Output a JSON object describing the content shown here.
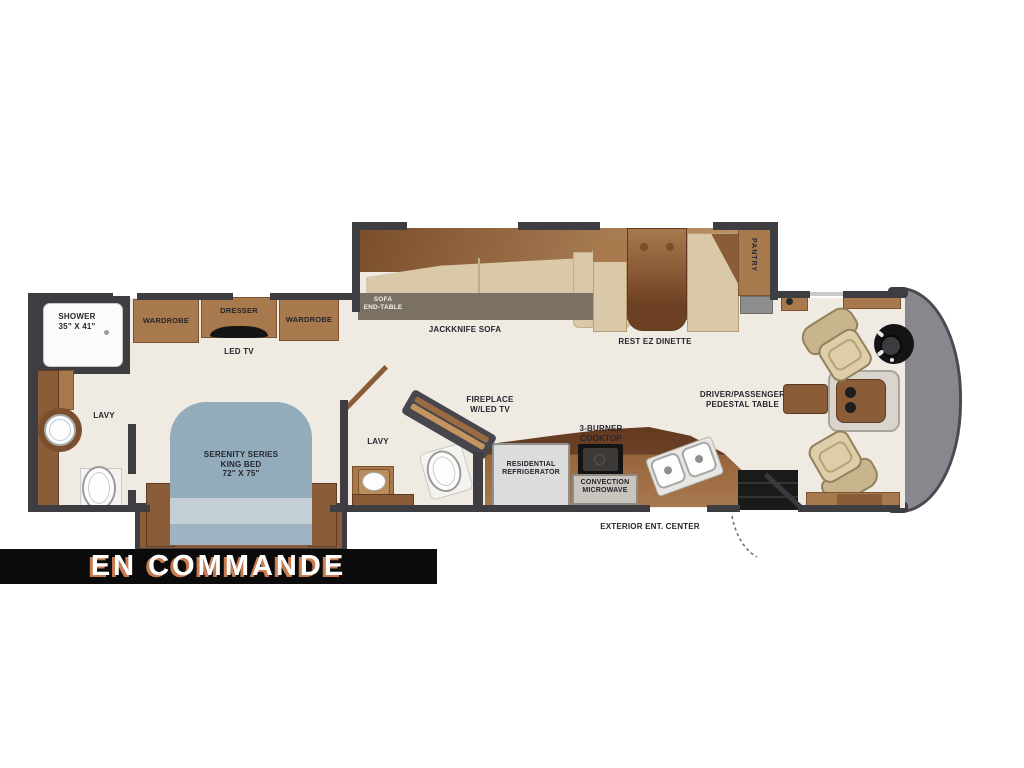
{
  "banner": {
    "text": "EN COMMANDE",
    "bg_color": "#0b0b0b",
    "text_color": "#ffffff",
    "shadow_color": "#c97b50"
  },
  "labels": {
    "shower_1": "SHOWER",
    "shower_2": "35\" X 41\"",
    "wardrobe_left": "WARDROBE",
    "dresser": "DRESSER",
    "wardrobe_right": "WARDROBE",
    "led_tv": "LED TV",
    "lavy_rear": "LAVY",
    "bed_1": "SERENITY SERIES",
    "bed_2": "KING BED",
    "bed_3": "72\" X 75\"",
    "lavy_mid": "LAVY",
    "sofa_end_1": "SOFA",
    "sofa_end_2": "END-TABLE",
    "jackknife_sofa": "JACKKNIFE SOFA",
    "dinette": "REST EZ DINETTE",
    "pantry": "PANTRY",
    "fireplace_1": "FIREPLACE",
    "fireplace_2": "W/LED TV",
    "fridge_1": "RESIDENTIAL",
    "fridge_2": "REFRIGERATOR",
    "cooktop_1": "3-BURNER",
    "cooktop_2": "COOKTOP",
    "micro_1": "CONVECTION",
    "micro_2": "MICROWAVE",
    "ext_center": "EXTERIOR ENT. CENTER",
    "pedestal_1": "DRIVER/PASSENGER",
    "pedestal_2": "PEDESTAL TABLE"
  },
  "colors": {
    "wall": "#3e3e42",
    "floor": "#efeae2",
    "cabinet_wood": "#a8794d",
    "cabinet_wood_dark": "#8a5c37",
    "bed_blue": "#93acbc",
    "bed_blue_light": "#c4ced5",
    "seat_tan": "#d9c9a8",
    "sofa_front_band": "#7b7163",
    "nose_gray": "#87878d",
    "appliance_gray": "#dcdcdc",
    "cooktop_black": "#141414"
  }
}
